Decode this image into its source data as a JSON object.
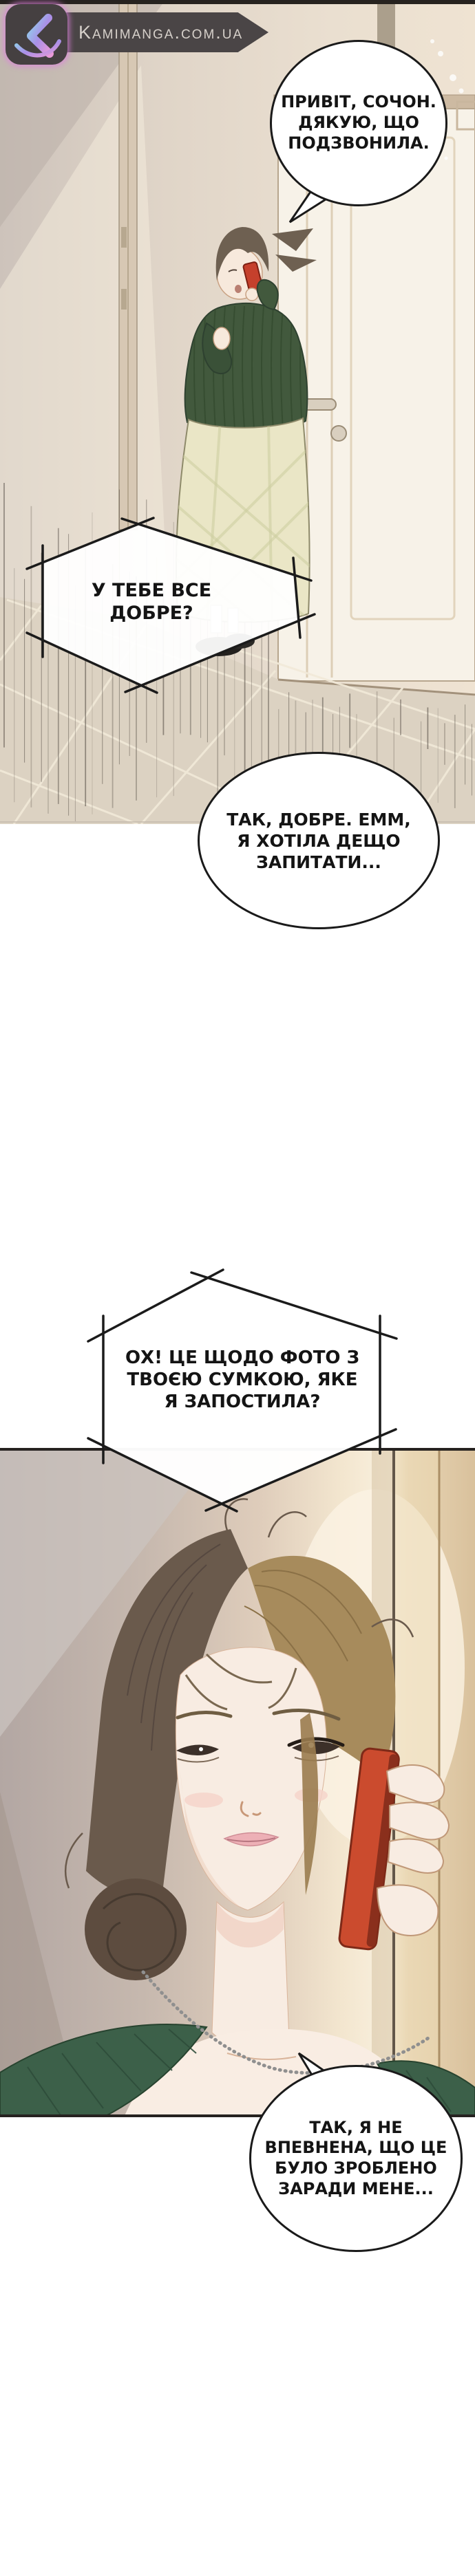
{
  "site": {
    "watermark": {
      "text": "Kamimanga.com.ua",
      "logo_letter": "K",
      "colors": {
        "badge_bg": "#454041",
        "badge_glow": "#d884d8",
        "banner_bg": "#4a4546",
        "banner_glow": "#5b7fd4",
        "text": "#d6d0ca",
        "logo_gradient": [
          "#8fd4ea",
          "#a98fe8",
          "#e89ad8"
        ]
      }
    }
  },
  "comic": {
    "language": "Ukrainian",
    "panels": [
      {
        "name": "hallway-scene",
        "description": "Woman in a dark green cardigan and pale plaid skirt stands by a white door, talking on a red phone"
      },
      {
        "name": "closeup-scene",
        "description": "Close-up of a woman with brown pinned-up hair holding a red phone to her ear, wearing a green top and chain necklace"
      }
    ],
    "bubbles": [
      {
        "shape": "ellipse",
        "lines": [
          "ПРИВІТ, СОЧОН.",
          "ДЯКУЮ, ЩО",
          "ПОДЗВОНИЛА."
        ]
      },
      {
        "shape": "phone-hexagon",
        "lines": [
          "У ТЕБЕ ВСЕ",
          "ДОБРЕ?"
        ]
      },
      {
        "shape": "ellipse",
        "lines": [
          "ТАК, ДОБРЕ. ЕММ,",
          "Я ХОТІЛА ДЕЩО",
          "ЗАПИТАТИ..."
        ]
      },
      {
        "shape": "phone-hexagon",
        "lines": [
          "ОХ! ЦЕ ЩОДО ФОТО З",
          "ТВОЄЮ СУМКОЮ, ЯКЕ",
          "Я ЗАПОСТИЛА?"
        ]
      },
      {
        "shape": "ellipse",
        "lines": [
          "ТАК, Я НЕ",
          "ВПЕВНЕНА, ЩО ЦЕ",
          "БУЛО ЗРОБЛЕНО",
          "ЗАРАДИ МЕНЕ..."
        ]
      }
    ],
    "palette": {
      "bubble_fill": "#ffffff",
      "bubble_stroke": "#1a1a1a",
      "text": "#141414",
      "cardigan_green": "#42593d",
      "top_green": "#3c6049",
      "phone_red": "#c94a2e",
      "hair_dark": "#6a5a4c",
      "hair_gold": "#a78b5c",
      "skin": "#f8ece2",
      "wall_beige": "#e3d8cb",
      "wall_mauve": "#b3a7a3",
      "floor": "#dcd2c2"
    }
  }
}
